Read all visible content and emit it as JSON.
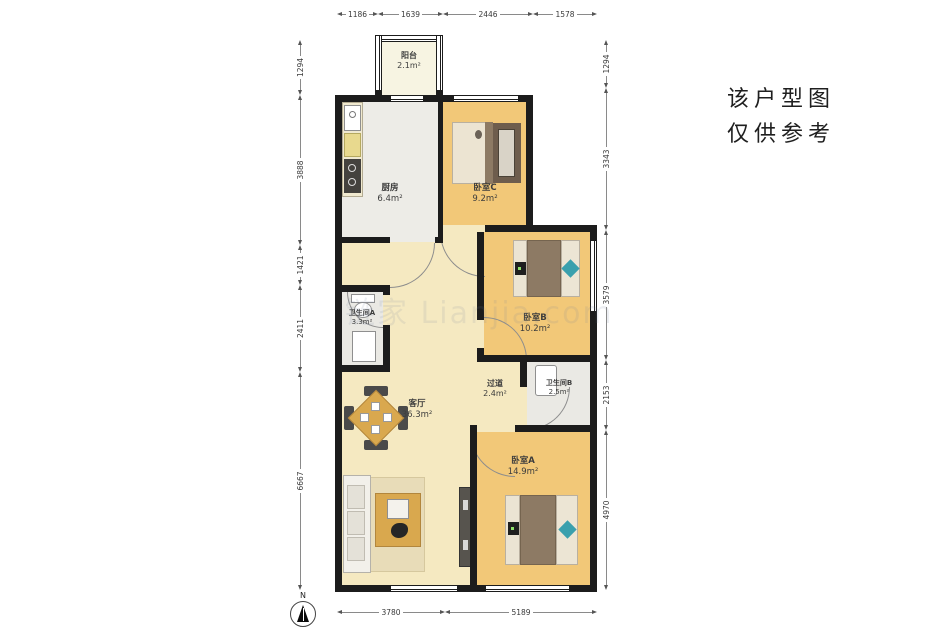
{
  "disclaimer": {
    "line1": "该户型图",
    "line2": "仅供参考"
  },
  "watermark": "链家 Lianjia.com",
  "compass": {
    "label": "N"
  },
  "rooms": {
    "balcony": {
      "name": "阳台",
      "area": "2.1m²"
    },
    "kitchen": {
      "name": "厨房",
      "area": "6.4m²"
    },
    "bedroom_c": {
      "name": "卧室C",
      "area": "9.2m²"
    },
    "bathroom_a": {
      "name": "卫生间A",
      "area": "3.3m²"
    },
    "bedroom_b": {
      "name": "卧室B",
      "area": "10.2m²"
    },
    "corridor": {
      "name": "过道",
      "area": "2.4m²"
    },
    "bathroom_b": {
      "name": "卫生间B",
      "area": "2.5m²"
    },
    "living_room": {
      "name": "客厅",
      "area": "36.3m²"
    },
    "bedroom_a": {
      "name": "卧室A",
      "area": "14.9m²"
    }
  },
  "dimensions": {
    "top": [
      "1186",
      "1639",
      "2446",
      "1578"
    ],
    "left": [
      "1294",
      "3888",
      "1421",
      "2411",
      "6667"
    ],
    "right": [
      "1294",
      "3343",
      "3579",
      "2153",
      "4970"
    ],
    "bottom": [
      "3780",
      "5189"
    ]
  },
  "colors": {
    "wall": "#1c1c1c",
    "wood_bedroom": "#f2c878",
    "wood_living": "#f5e9c1",
    "tile_gray": "#edece7",
    "balcony_floor": "#f7f4e2",
    "bed_blanket": "#8d7a64",
    "accent_teal": "#3aa0ad",
    "table_wood": "#d9a84e"
  }
}
